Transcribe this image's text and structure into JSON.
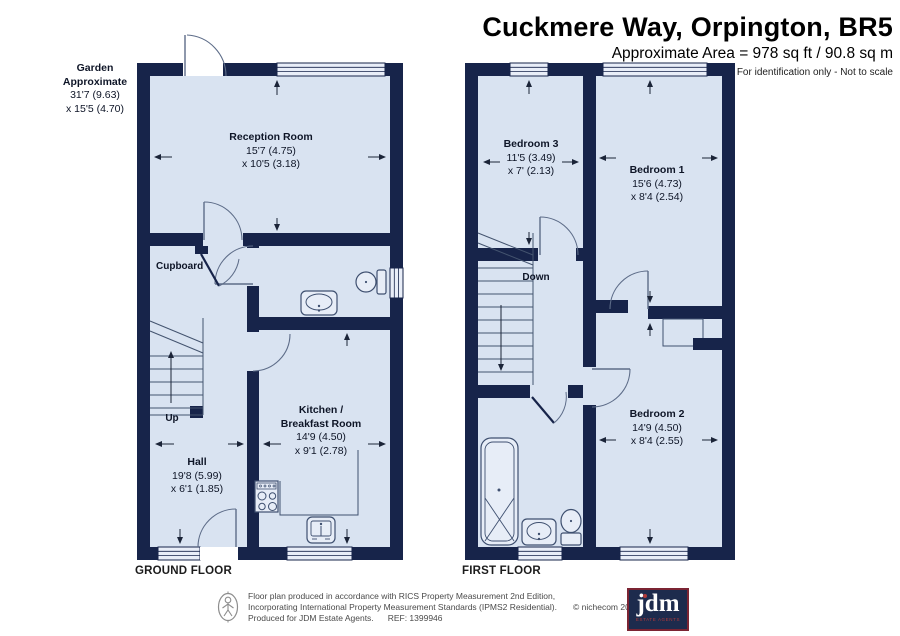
{
  "header": {
    "title": "Cuckmere Way, Orpington, BR5",
    "area_line": "Approximate Area = 978 sq ft / 90.8 sq m",
    "disclaimer": "For identification only - Not to scale"
  },
  "ground_floor": {
    "floor_label": "GROUND FLOOR",
    "garden": {
      "name_line1": "Garden",
      "name_line2": "Approximate",
      "dim_line1": "31'7 (9.63)",
      "dim_line2": "x 15'5 (4.70)"
    },
    "reception": {
      "name": "Reception Room",
      "dim1": "15'7 (4.75)",
      "dim2": "x 10'5 (3.18)"
    },
    "cupboard": {
      "name": "Cupboard"
    },
    "hall": {
      "name": "Hall",
      "dim1": "19'8 (5.99)",
      "dim2": "x 6'1 (1.85)"
    },
    "kitchen": {
      "name_line1": "Kitchen /",
      "name_line2": "Breakfast Room",
      "dim1": "14'9 (4.50)",
      "dim2": "x 9'1 (2.78)"
    },
    "stairs_label": "Up"
  },
  "first_floor": {
    "floor_label": "FIRST FLOOR",
    "bedroom1": {
      "name": "Bedroom 1",
      "dim1": "15'6 (4.73)",
      "dim2": "x 8'4 (2.54)"
    },
    "bedroom2": {
      "name": "Bedroom 2",
      "dim1": "14'9 (4.50)",
      "dim2": "x 8'4 (2.55)"
    },
    "bedroom3": {
      "name": "Bedroom 3",
      "dim1": "11'5 (3.49)",
      "dim2": "x 7' (2.13)"
    },
    "stairs_label": "Down"
  },
  "footer": {
    "line1": "Floor plan produced in accordance with RICS Property Measurement 2nd Edition,",
    "line2": "Incorporating International Property Measurement Standards (IPMS2 Residential).",
    "copyright": "© nichecom 2026.",
    "line3": "Produced for JDM Estate Agents.",
    "ref": "REF: 1399946",
    "logo_text": "jdm",
    "logo_subtitle": "ESTATE AGENTS"
  },
  "colors": {
    "wall": "#17244a",
    "floor": "#d9e3f1",
    "window": "#e9eef8",
    "logo_background": "#1d2b4d",
    "logo_border": "#7b2433",
    "logo_accent": "#b03a3a"
  }
}
